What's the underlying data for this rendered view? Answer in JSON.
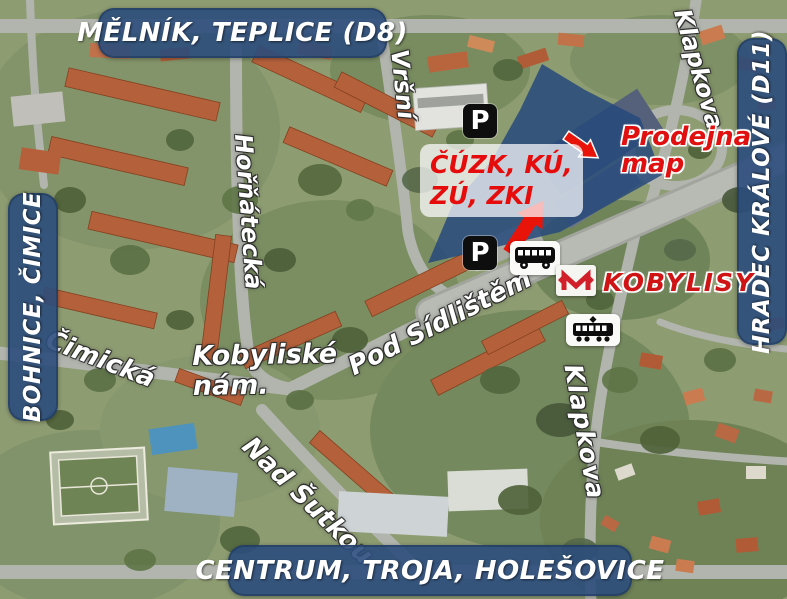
{
  "banners": {
    "top": "MĚLNÍK, TEPLICE (D8)",
    "left": "BOHNICE, ČIMICE",
    "right": "HRADEC KRÁLOVÉ (D11)",
    "bottom": "CENTRUM, TROJA, HOLEŠOVICE"
  },
  "streets": {
    "vrsni": "Vršní",
    "hornatecka": "Hořňátecká",
    "klapkova_north": "Klapkova",
    "klapkova_south": "Klapkova",
    "cimicka": "Čimická",
    "kobyliske_line1": "Kobyliské",
    "kobyliske_line2": "nám.",
    "pod_sidlistem": "Pod Sídlištěm",
    "nad_sutkou": "Nad Šutkou"
  },
  "callouts": {
    "office_line1": "ČÚZK, KÚ,",
    "office_line2": "ZÚ, ZKI",
    "shop_line1": "Prodejna",
    "shop_line2": "map",
    "metro_station": "KOBYLISY"
  },
  "symbols": {
    "parking": "P"
  },
  "icons": {
    "parking": "parking-icon",
    "bus": "bus-icon",
    "tram": "tram-icon",
    "metro_logo": "prague-metro-logo",
    "arrow": "red-arrow"
  },
  "colors": {
    "banner_blue": "#2b4d7c",
    "callout_red": "#e11010",
    "metro_red": "#d1202a",
    "highlight_blue": "#26497b",
    "arrow_red": "#e81409",
    "street_label": "#ffffff"
  }
}
